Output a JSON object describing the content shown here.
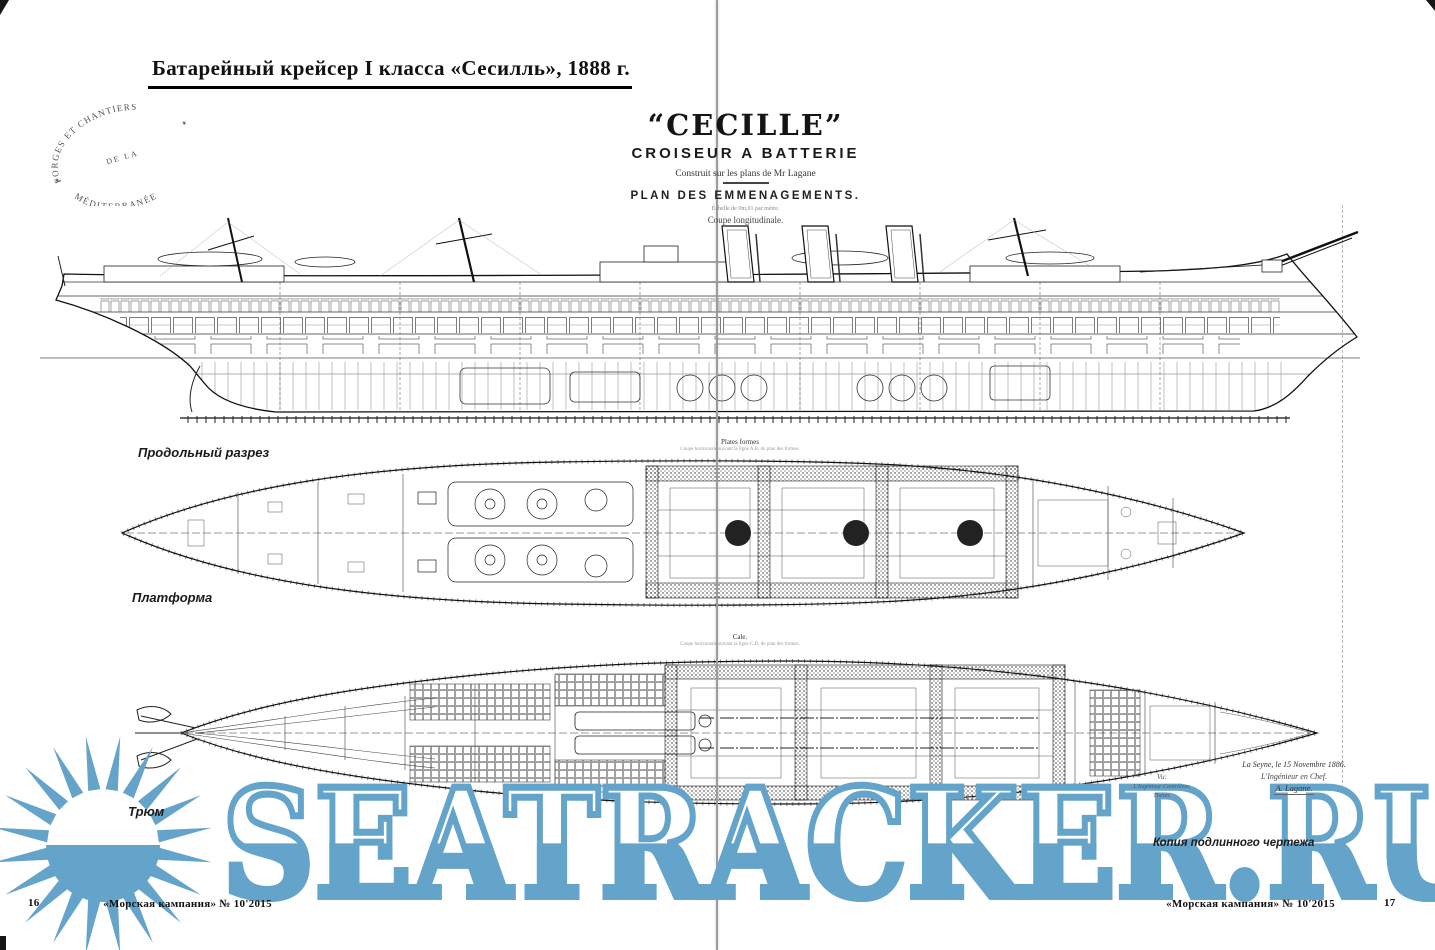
{
  "page": {
    "header_title": "Батарейный крейсер I класса  «Сесилль», 1888 г.",
    "footer_journal_left": "«Морская кампания» № 10'2015",
    "footer_journal_right": "«Морская кампания» № 10'2015",
    "page_number_left": "16",
    "page_number_right": "17",
    "copy_note": "Копия подлинного чертежа"
  },
  "stamp": {
    "arc_top": "FORGES ET CHANTIERS",
    "middle": "DE LA",
    "arc_bottom": "MÉDITERRANÉE",
    "star_left": "✶",
    "star_right": "✶"
  },
  "title_block": {
    "ship_name": "“CECILLE”",
    "type_line": "CROISEUR A BATTERIE",
    "credit_line": "Construit sur les plans de Mr Lagane",
    "plan_line": "PLAN DES EMMENAGEMENTS.",
    "scale_line": "Échelle de 0m,01 par mètre.",
    "view_caption": "Coupe longitudinale."
  },
  "drawing_labels": {
    "longitudinal_section": "Продольный разрез",
    "platform": "Платформа",
    "hold": "Трюм",
    "platform_caption": "Plates formes",
    "platform_subcaption": "Coupe horizontale suivant la ligne A.B. du plan des formes.",
    "hold_caption": "Cale.",
    "hold_subcaption": "Coupe horizontale suivant la ligne C.D. du plan des formes."
  },
  "signatures": {
    "right_date": "La Seyne, le 15 Novembre 1886.",
    "right_title": "L'Ingénieur en Chef.",
    "right_name": "A. Lagane.",
    "left_vu": "Vu:",
    "left_title": "L'Ingénieur Contrôleur,",
    "left_name": "Théon."
  },
  "watermark": {
    "text": "SEATRACKER.RU",
    "color": "#64a3ca",
    "logo": "sun"
  }
}
